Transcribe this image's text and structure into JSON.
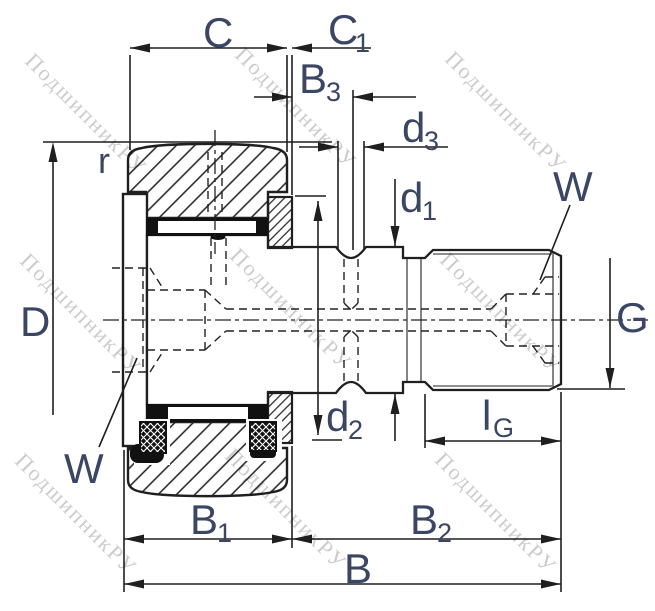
{
  "drawing": {
    "type": "technical-drawing",
    "subject": "stud-type cam follower bearing cross-section",
    "colors": {
      "line": "#1f1f1f",
      "label": "#3a4663",
      "watermark": "#c4c4c4",
      "background": "#ffffff"
    }
  },
  "watermark": {
    "text": "ПодшипникРУ"
  },
  "labels": {
    "C": "C",
    "C1_main": "C",
    "C1_sub": "1",
    "B3_main": "B",
    "B3_sub": "3",
    "d3_main": "d",
    "d3_sub": "3",
    "d1_main": "d",
    "d1_sub": "1",
    "d2_main": "d",
    "d2_sub": "2",
    "r": "r",
    "D": "D",
    "W_top": "W",
    "W_bottom": "W",
    "G": "G",
    "lG_main": "l",
    "lG_sub": "G",
    "B1_main": "B",
    "B1_sub": "1",
    "B2_main": "B",
    "B2_sub": "2",
    "B": "B"
  }
}
